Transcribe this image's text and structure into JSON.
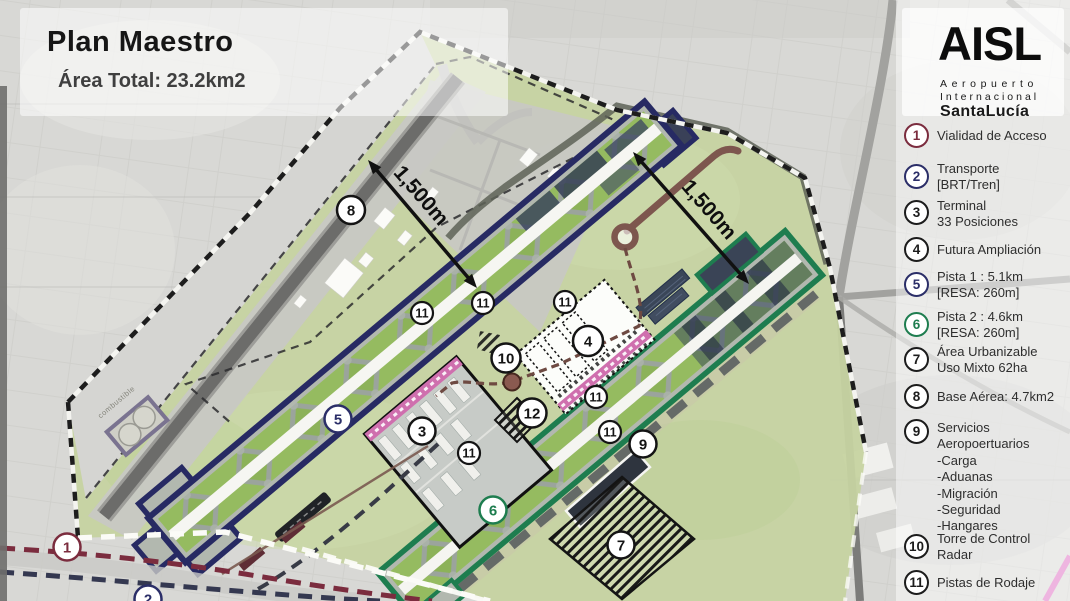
{
  "title": {
    "heading": "Plan Maestro",
    "subtitle": "Área Total: 23.2km2"
  },
  "logo": {
    "acronym": "AISL",
    "line1": "Aeropuerto",
    "line2": "Internacional",
    "line3": "SantaLucía"
  },
  "legend": {
    "items": [
      {
        "num": "1",
        "color": "#7b2c3e",
        "lines": [
          "Vialidad de Acceso"
        ]
      },
      {
        "num": "2",
        "color": "#2b2e68",
        "lines": [
          "Transporte",
          "[BRT/Tren]"
        ]
      },
      {
        "num": "3",
        "color": "#1c1c1c",
        "lines": [
          "Terminal",
          "33 Posiciones"
        ]
      },
      {
        "num": "4",
        "color": "#1c1c1c",
        "lines": [
          "Futura Ampliación"
        ]
      },
      {
        "num": "5",
        "color": "#2b2e68",
        "lines": [
          "Pista 1 : 5.1km",
          "[RESA: 260m]"
        ]
      },
      {
        "num": "6",
        "color": "#1e7d4f",
        "lines": [
          "Pista 2 : 4.6km",
          "[RESA: 260m]"
        ]
      },
      {
        "num": "7",
        "color": "#1c1c1c",
        "lines": [
          "Área Urbanizable",
          "Uso Mixto 62ha"
        ]
      },
      {
        "num": "8",
        "color": "#1c1c1c",
        "lines": [
          "Base Aérea: 4.7km2"
        ]
      },
      {
        "num": "9",
        "color": "#1c1c1c",
        "lines": [
          "Servicios",
          "Aeropoertuarios",
          "-Carga",
          "-Aduanas",
          "-Migración",
          "-Seguridad",
          "-Hangares"
        ]
      },
      {
        "num": "10",
        "color": "#1c1c1c",
        "lines": [
          "Torre de Control",
          "Radar"
        ]
      },
      {
        "num": "11",
        "color": "#1c1c1c",
        "lines": [
          "Pistas de Rodaje"
        ]
      }
    ]
  },
  "map": {
    "distance_labels": [
      {
        "text": "1,500m"
      },
      {
        "text": "1,500m"
      }
    ],
    "fuel_label": "combustible",
    "markers": [
      {
        "n": "1",
        "x": 67,
        "y": 547,
        "r": 13.5,
        "color": "#7b2c3e"
      },
      {
        "n": "2",
        "x": 148,
        "y": 599,
        "r": 13.5,
        "color": "#2b2e68"
      },
      {
        "n": "3",
        "x": 422,
        "y": 431,
        "r": 13.5,
        "color": "#141414"
      },
      {
        "n": "4",
        "x": 588,
        "y": 341,
        "r": 15,
        "color": "#141414"
      },
      {
        "n": "5",
        "x": 338,
        "y": 419,
        "r": 13.5,
        "color": "#2b2e68"
      },
      {
        "n": "6",
        "x": 493,
        "y": 510,
        "r": 13.5,
        "color": "#1e7d4f"
      },
      {
        "n": "7",
        "x": 621,
        "y": 545,
        "r": 13.5,
        "color": "#141414"
      },
      {
        "n": "8",
        "x": 351,
        "y": 210,
        "r": 14,
        "color": "#141414"
      },
      {
        "n": "9",
        "x": 643,
        "y": 444,
        "r": 13.5,
        "color": "#141414"
      },
      {
        "n": "10",
        "x": 506,
        "y": 358,
        "r": 14.5,
        "color": "#141414"
      },
      {
        "n": "12",
        "x": 532,
        "y": 413,
        "r": 14.5,
        "color": "#141414"
      },
      {
        "n": "11",
        "x": 422,
        "y": 313,
        "r": 11,
        "color": "#141414"
      },
      {
        "n": "11",
        "x": 483,
        "y": 303,
        "r": 11,
        "color": "#141414"
      },
      {
        "n": "11",
        "x": 565,
        "y": 302,
        "r": 11,
        "color": "#141414"
      },
      {
        "n": "11",
        "x": 596,
        "y": 397,
        "r": 11,
        "color": "#141414"
      },
      {
        "n": "11",
        "x": 610,
        "y": 432,
        "r": 11,
        "color": "#141414"
      },
      {
        "n": "11",
        "x": 469,
        "y": 453,
        "r": 11,
        "color": "#141414"
      }
    ]
  },
  "colors": {
    "pista1_navy": "#2b2e68",
    "pista2_green": "#1e7d4f",
    "access_maroon": "#7b2c3e",
    "terminal_pink": "#cf6fae",
    "site_green": "#c6d3a1"
  }
}
